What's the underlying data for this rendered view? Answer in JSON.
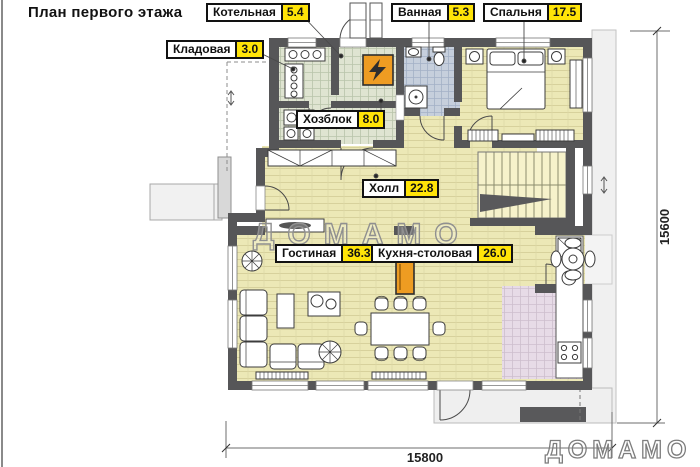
{
  "title": "План первого этажа",
  "rooms": [
    {
      "name": "Котельная",
      "area": "5.4"
    },
    {
      "name": "Ванная",
      "area": "5.3"
    },
    {
      "name": "Спальня",
      "area": "17.5"
    },
    {
      "name": "Кладовая",
      "area": "3.0"
    },
    {
      "name": "Хозблок",
      "area": "8.0"
    },
    {
      "name": "Холл",
      "area": "22.8"
    },
    {
      "name": "Гостиная",
      "area": "36.3"
    },
    {
      "name": "Кухня-столовая",
      "area": "26.0"
    }
  ],
  "dimensions": {
    "bottom": "15800",
    "right": "15600"
  },
  "watermark": {
    "text": "ДОМАМО"
  },
  "colors": {
    "wall": "#565658",
    "area_badge": "#ffe408",
    "floor_wood": "#ece8b6",
    "floor_tile_green": "#dfe4d1",
    "floor_tile_blue": "#c6cfdc",
    "floor_tile_pink": "#e7dbe7",
    "stairs_floor": "#f6f2cb",
    "accent_orange": "#ee9c22",
    "pavement": "#f0f0f0"
  }
}
